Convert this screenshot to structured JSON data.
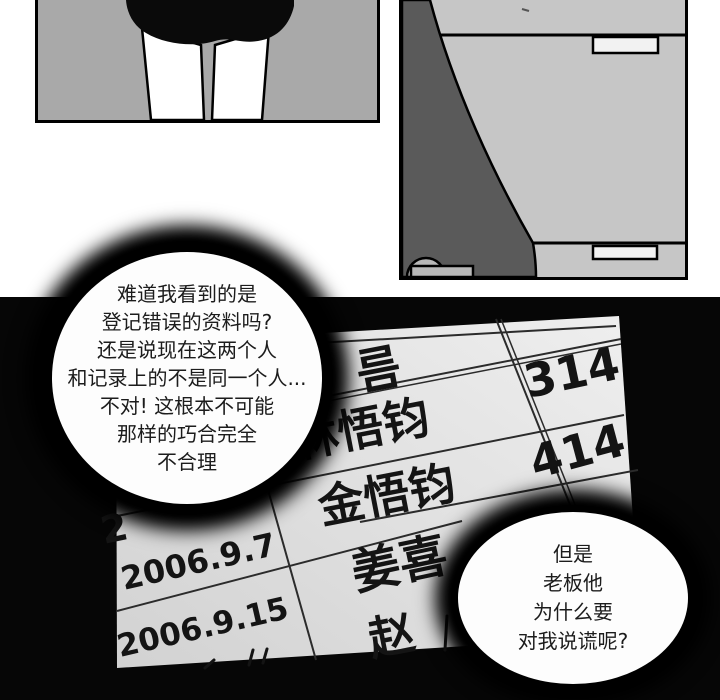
{
  "comic": {
    "section_top_bg": "#ffffff",
    "section_bottom_bg": "#060606",
    "panel_legs": {
      "description": "figure from waist down, black shorts and bare legs",
      "bg_color": "#a9a9a9"
    },
    "panel_cabinet": {
      "description": "corner of drawers/cabinet with dark curved shadow and caster wheel",
      "bg_color": "#c6c6c6",
      "dark_shape_color": "#5a5a5a",
      "handle_color": "#f2f2f2"
    }
  },
  "speech_bubbles": {
    "bubble1": {
      "lines": [
        "难道我看到的是",
        "登记错误的资料吗?",
        "还是说现在这两个人",
        "和记录上的不是同一个人...",
        "不对! 这根本不可能",
        "那样的巧合完全",
        "不合理"
      ]
    },
    "bubble2": {
      "lines": [
        "但是",
        "老板他",
        "为什么要",
        "对我说谎呢?"
      ]
    }
  },
  "ledger": {
    "paper_color": "#e6e6e6",
    "line_color": "#2b2b2b",
    "ink_color": "#141414",
    "header_name": "름",
    "rows": [
      {
        "date": "",
        "name": "林悟钧",
        "room": "314"
      },
      {
        "date": "2",
        "name": "金悟钧",
        "room": "414"
      },
      {
        "date": "2006.9.7",
        "name": "姜喜",
        "room": ""
      },
      {
        "date": "2006.9.15",
        "name": "赵",
        "room": ""
      }
    ]
  }
}
